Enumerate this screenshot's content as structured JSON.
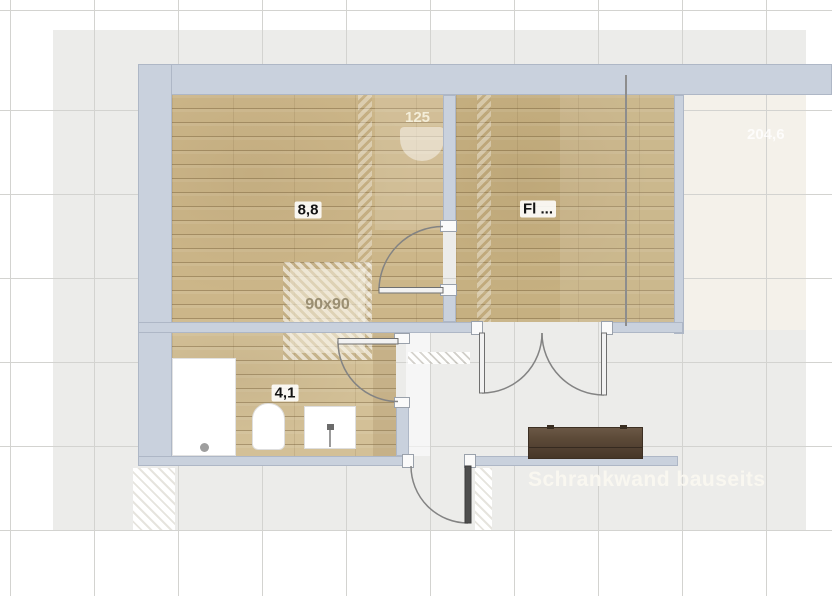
{
  "plan": {
    "title": "floor-plan",
    "rooms": [
      {
        "name": "main-room",
        "area_label": "8,8"
      },
      {
        "name": "hall-room",
        "area_label": "Fl ..."
      },
      {
        "name": "bathroom",
        "area_label": "4,1"
      }
    ],
    "annotations": {
      "ghost_dimension": "125",
      "shower_size": "90x90",
      "right_dimension": "204,6",
      "cabinet_note": "Schrankwand bauseits"
    },
    "colors": {
      "wall": "#c9d1dd",
      "wood": "#ccb689",
      "slab": "#ececea",
      "beige_area": "#f4f1ea",
      "sideboard": "#5c4a38"
    }
  }
}
